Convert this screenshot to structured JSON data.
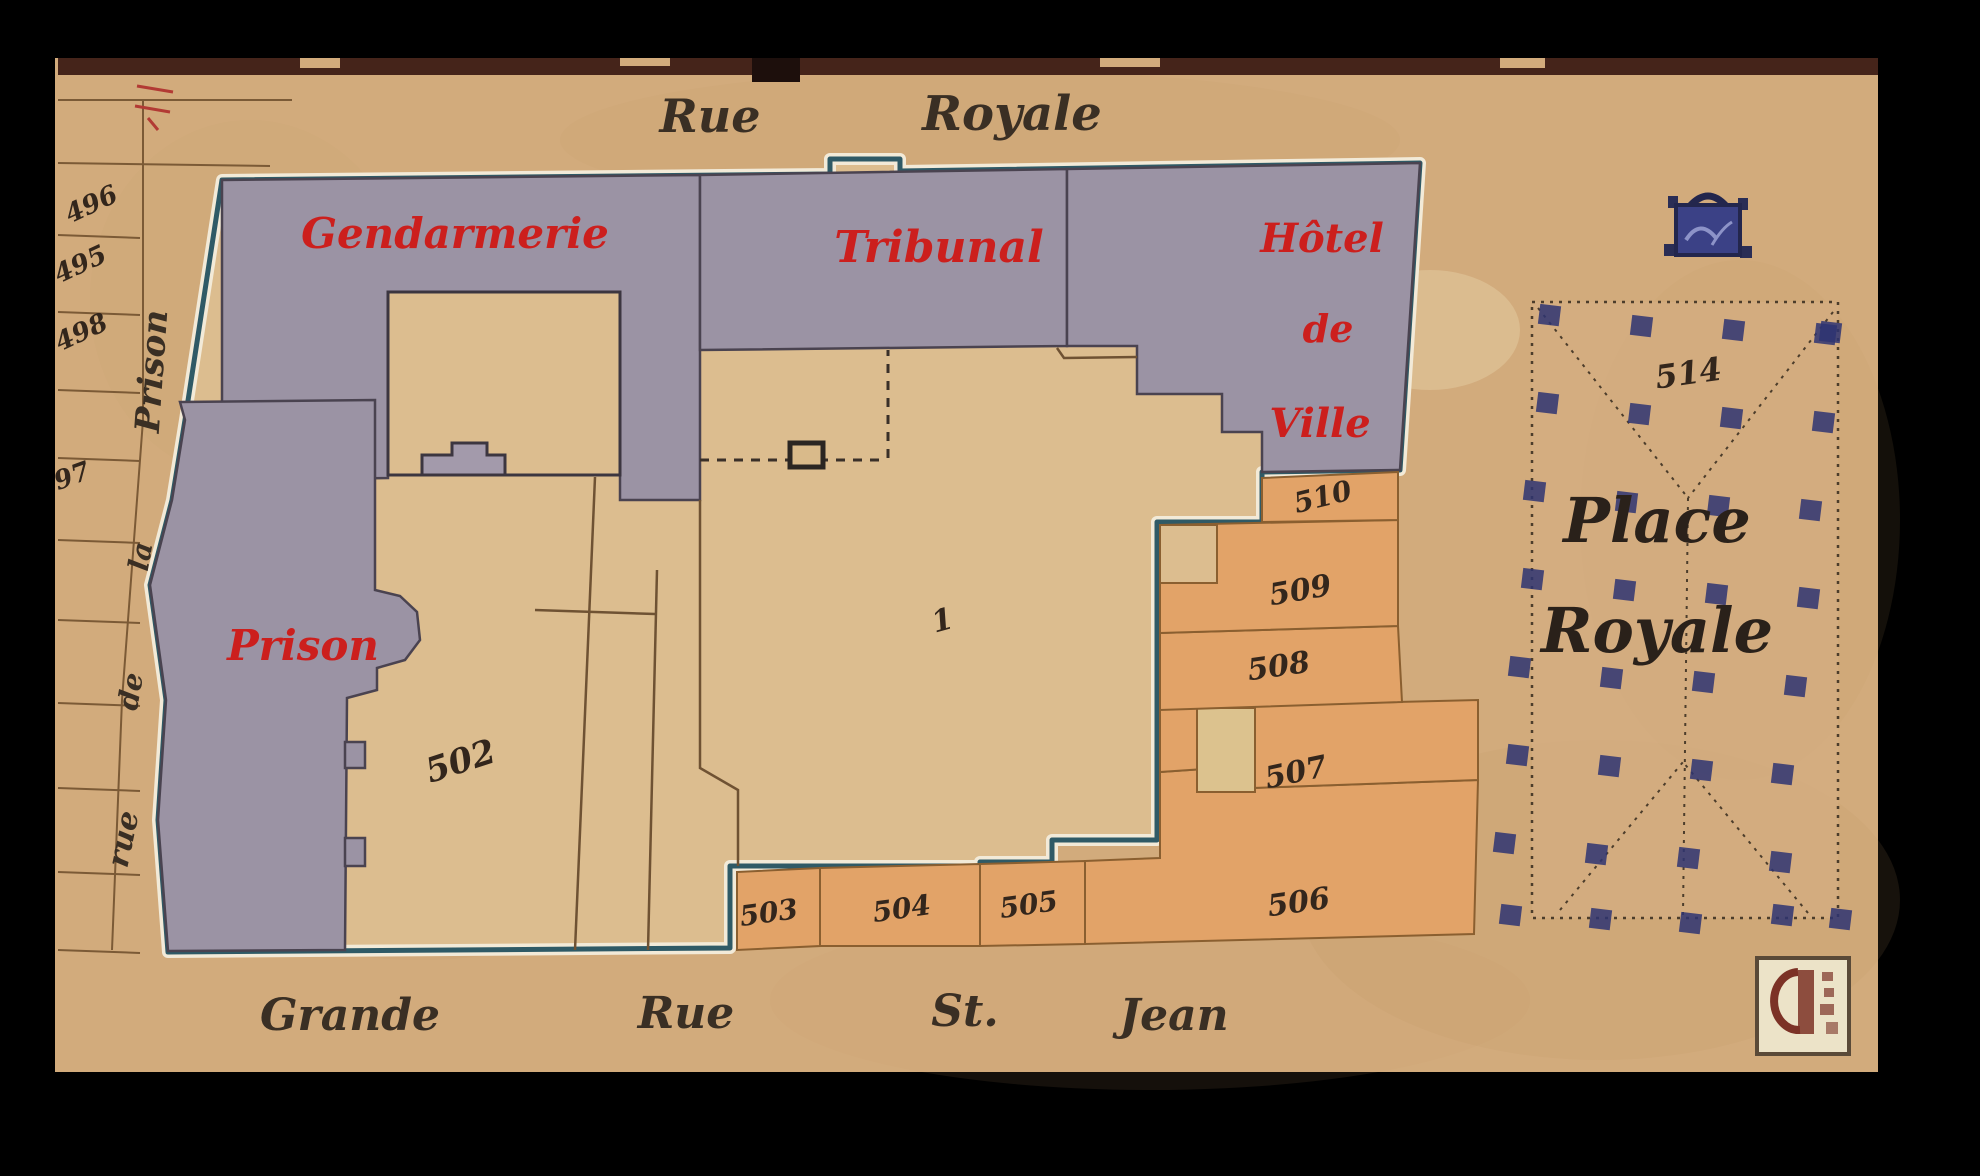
{
  "map": {
    "streets": {
      "top": [
        "Rue",
        "Royale"
      ],
      "bottom": [
        "Grande",
        "Rue",
        "St.",
        "Jean"
      ],
      "left_vertical": [
        "rue",
        "de",
        "la",
        "Prison"
      ]
    },
    "buildings": {
      "gendarmerie": "Gendarmerie",
      "tribunal": "Tribunal",
      "hotel_de_ville": [
        "Hôtel",
        "de",
        "Ville"
      ],
      "prison": "Prison"
    },
    "place": {
      "name": [
        "Place",
        "Royale"
      ],
      "parcel_number": "514"
    },
    "parcel_numbers": {
      "left_margin": [
        "496",
        "495",
        "498",
        "97"
      ],
      "courtyard_left": "502",
      "courtyard_center": "1",
      "south_row": [
        "503",
        "504",
        "505",
        "506"
      ],
      "east_column": [
        "510",
        "509",
        "508",
        "507"
      ]
    },
    "colors": {
      "background": "#000000",
      "parchment": "#d2ab7c",
      "interior_beige": "#dcbd8f",
      "building_gray": "#9b93a4",
      "parcel_orange": "#e2a368",
      "parcel_pale": "#dcc28e",
      "outline_teal": "#2f5a66",
      "outline_white": "#f2ead8",
      "label_red": "#cc1f1d",
      "ink": "#33281e",
      "tree_blue": "#2e3472"
    }
  }
}
